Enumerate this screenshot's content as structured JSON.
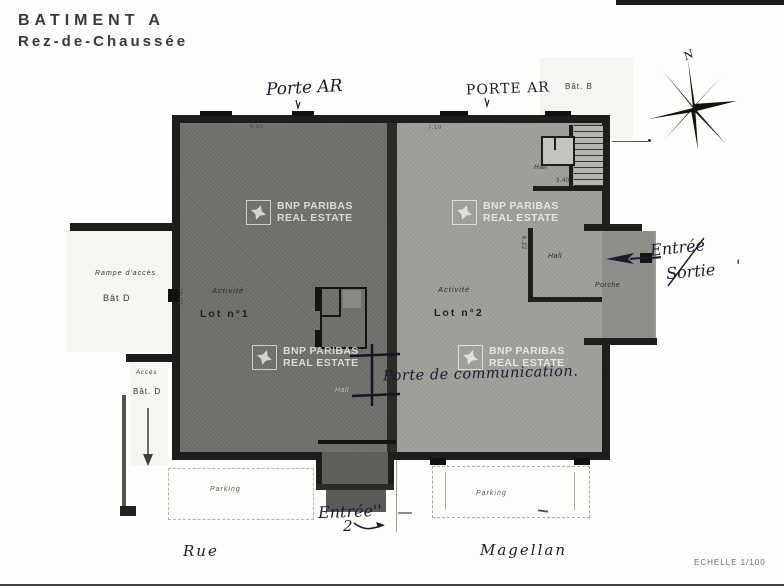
{
  "title": {
    "line1": "BATIMENT A",
    "line2": "Rez-de-Chaussée"
  },
  "compass": {
    "label": "N"
  },
  "zones": {
    "bat_b": "Bât. B",
    "rampe_acces": "Rampe d'accès",
    "bat_d_upper": "Bât D",
    "acces": "Accès",
    "bat_d_lower": "Bât. D"
  },
  "lots": {
    "lot1": {
      "activity": "Activité",
      "name": "Lot n°1"
    },
    "lot2": {
      "activity": "Activité",
      "name": "Lot n°2"
    }
  },
  "rooms": {
    "hall_stairs": "Hall",
    "hall_right": "Hall",
    "hall_center": "Hall",
    "porche": "Porche"
  },
  "dimensions": {
    "top_left": "9.55",
    "top_right": "7.10",
    "stairs": "3.40",
    "hall_right": "6.22",
    "left_wall": "16.91",
    "center": "3.37"
  },
  "parking": {
    "left": "Parking",
    "right": "Parking"
  },
  "streets": {
    "left": "Rue",
    "right": "Magellan"
  },
  "scale_label": "ECHELLE 1/100",
  "watermark": {
    "line1": "BNP PARIBAS",
    "line2": "REAL ESTATE"
  },
  "annotations": {
    "porte_ar_left": "Porte AR",
    "porte_ar_right": "PORTE AR",
    "entree": "Entrée",
    "sortie": "Sortie",
    "mark": "'",
    "porte_communication": "Porte de communication.",
    "entree_bottom": "Entrée''",
    "entree_bottom_num": "2"
  }
}
